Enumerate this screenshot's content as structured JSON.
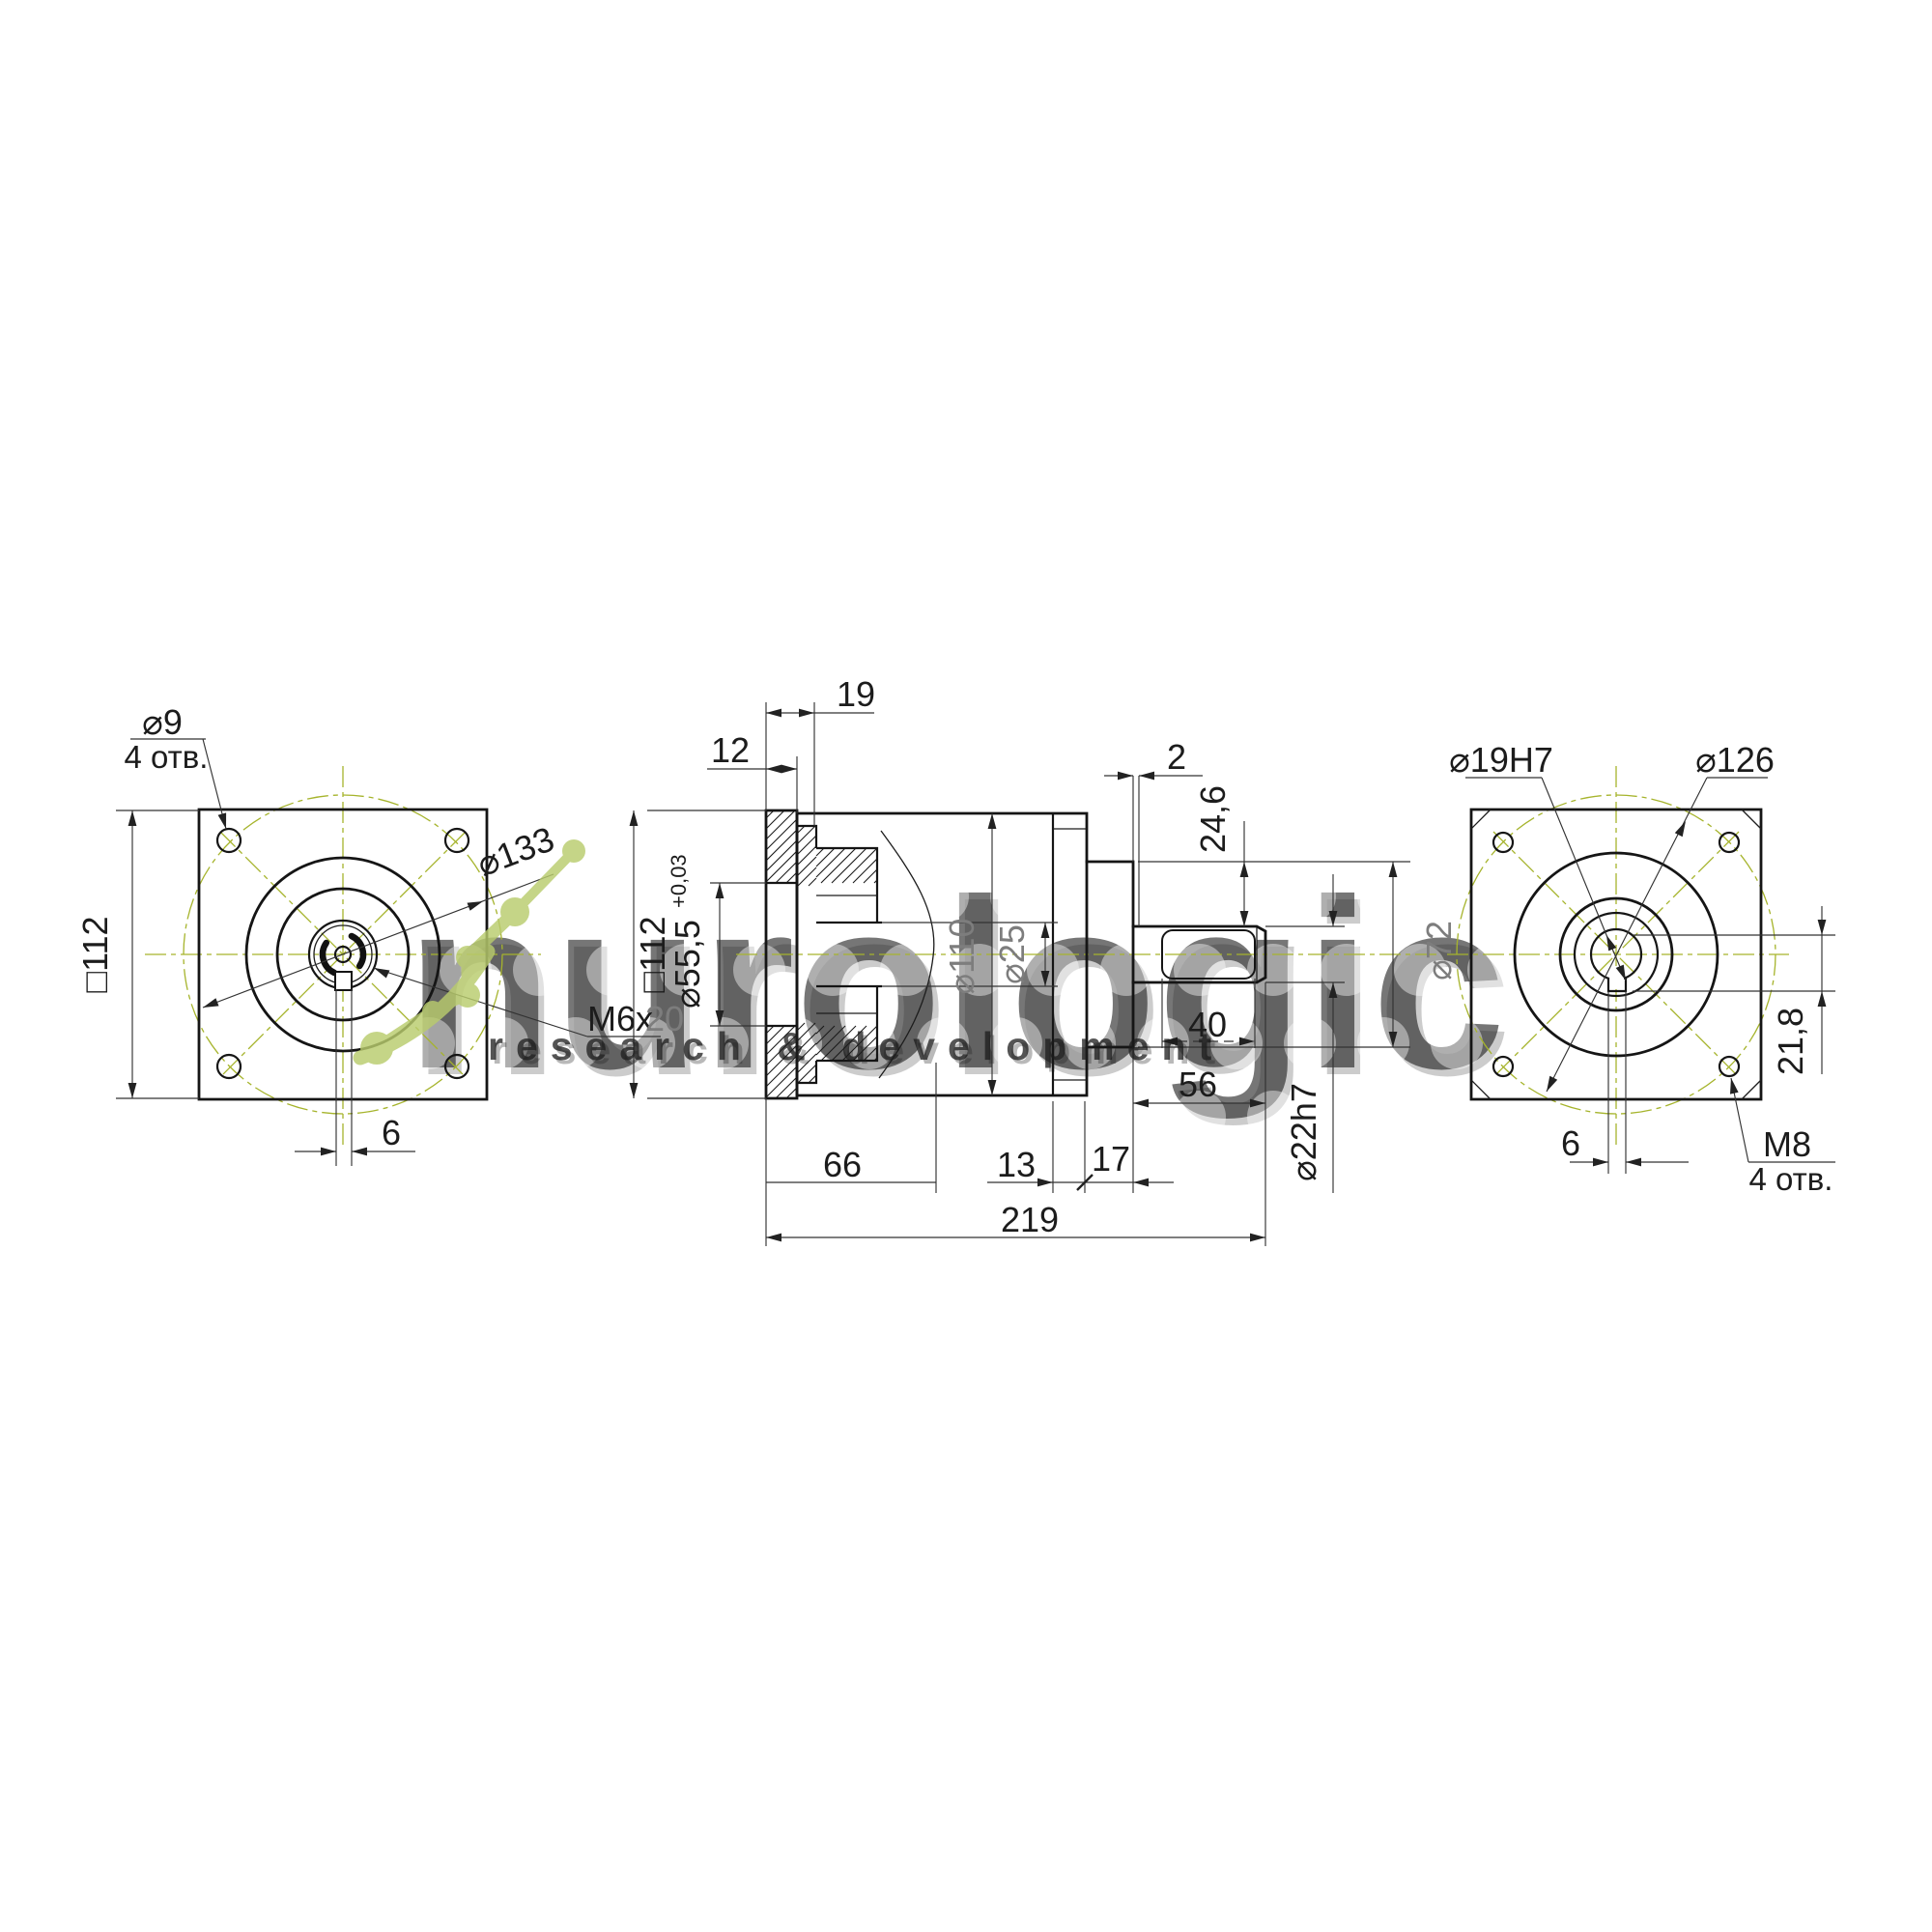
{
  "title": "gearbox technical drawing",
  "watermark": {
    "brand": "nurologic",
    "tagline": "research & development",
    "molecule_color": "#b9cc6d"
  },
  "colors": {
    "line": "#151515",
    "dimension": "#333333",
    "centerline_green": "#a6b42c",
    "faded_label_gray": "#7d7d7d",
    "background": "#ffffff"
  },
  "front": {
    "hole_dia": "⌀9",
    "hole_count": "4 отв.",
    "bolt_circle": "⌀133",
    "square": "□112",
    "thread": "M6x",
    "thread_depth": "20",
    "key_width": "6"
  },
  "section": {
    "pilot_depth": "19",
    "flange_thickness": "12",
    "square": "□112",
    "pilot_bore": "⌀55,5",
    "pilot_bore_tol": "+0,03",
    "body_dia": "⌀110",
    "input_bore": "⌀25",
    "gap": "2",
    "shoulder": "24,6",
    "key_length": "40",
    "shaft_length": "56",
    "boss_dia": "⌀72",
    "shaft_dia": "⌀22h7",
    "hub_length": "66",
    "wall": "13",
    "boss_length": "17",
    "total_length": "219"
  },
  "rear": {
    "center_bore": "⌀19H7",
    "bolt_circle": "⌀126",
    "key_depth": "21,8",
    "key_width": "6",
    "thread": "M8",
    "thread_count": "4 отв."
  }
}
